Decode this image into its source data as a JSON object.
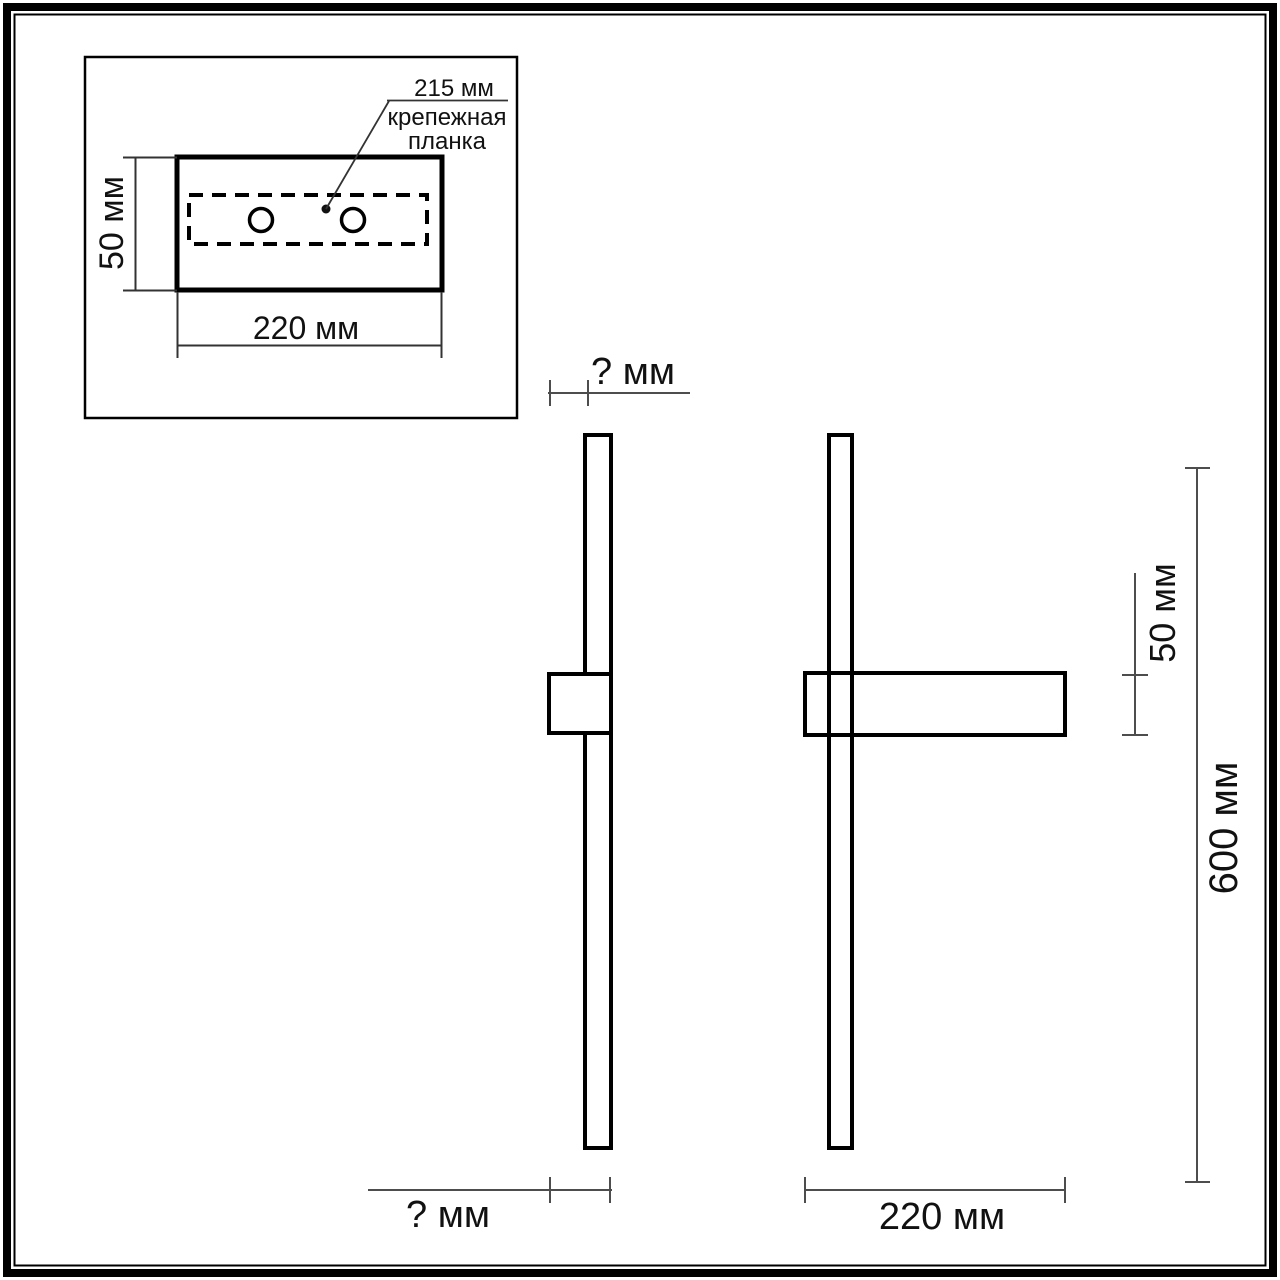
{
  "drawing_title": "wall-lamp-dimension-drawing",
  "colors": {
    "background": "#ffffff",
    "object_line": "#000000",
    "dimension_line": "#4d4d4d",
    "text": "#111111"
  },
  "inset": {
    "plate_dim_label": "215 мм",
    "plate_name_line1": "крепежная",
    "plate_name_line2": "планка",
    "height_dim_label": "50 мм",
    "width_dim_label": "220 мм"
  },
  "side_view": {
    "depth_top_dim_label": "? мм",
    "depth_bottom_dim_label": "? мм"
  },
  "front_view": {
    "bracket_height_dim_label": "50 мм",
    "lamp_height_dim_label": "600 мм",
    "bracket_width_dim_label": "220 мм"
  }
}
